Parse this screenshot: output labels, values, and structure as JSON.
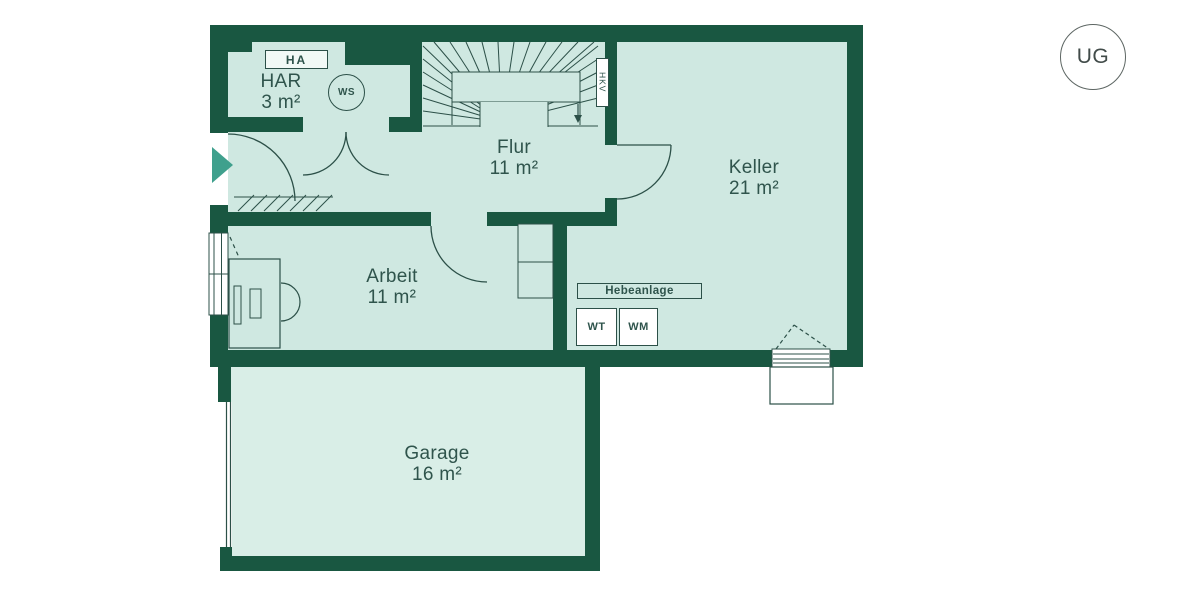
{
  "floor_badge": "UG",
  "rooms": [
    {
      "id": "har",
      "name": "HAR",
      "area": "3 m²"
    },
    {
      "id": "flur",
      "name": "Flur",
      "area": "11 m²"
    },
    {
      "id": "keller",
      "name": "Keller",
      "area": "21 m²"
    },
    {
      "id": "arbeit",
      "name": "Arbeit",
      "area": "11 m²"
    },
    {
      "id": "garage",
      "name": "Garage",
      "area": "16 m²"
    }
  ],
  "tags": {
    "house_connection_box": "HA",
    "water_softener": "WS",
    "heating_circuit_distributor": "HKV",
    "lifting_station": "Hebeanlage",
    "washtub": "WT",
    "washing_machine": "WM"
  },
  "colors": {
    "wall": "#195741",
    "room_fill": "#cfe8e1",
    "garage_fill": "#d9eee7",
    "line": "#2c5048",
    "text": "#2f544c",
    "entrance_accent": "#3fa08d",
    "background": "#ffffff"
  }
}
